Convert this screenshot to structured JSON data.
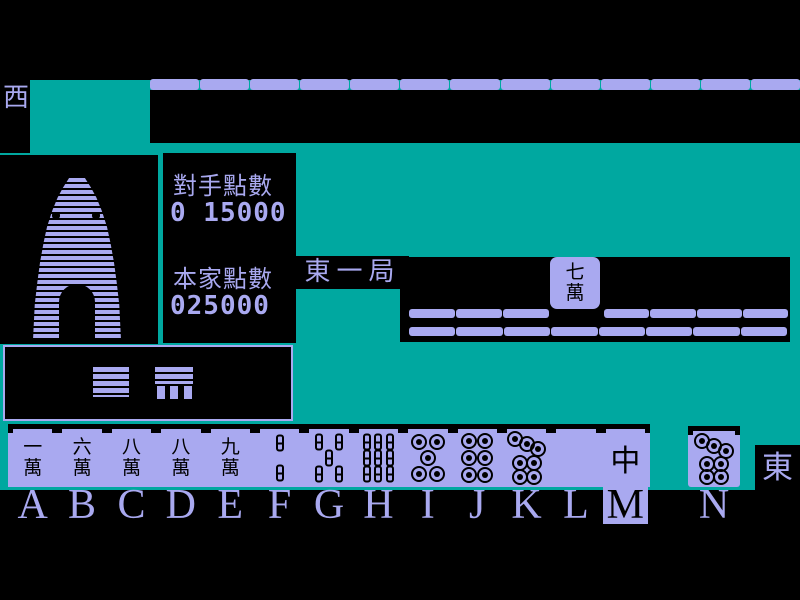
{
  "palette": {
    "teal": "#00A8A0",
    "lavender": "#A9A9F0",
    "black": "#000000"
  },
  "labels": {
    "west_wind": "西",
    "east_wind": "東",
    "round": "東一局"
  },
  "scoreboard": {
    "opponent_label": "對手點數",
    "opponent_value": "0 15000",
    "player_label": "本家點數",
    "player_value": "025000"
  },
  "discard": {
    "tile_text": "七萬"
  },
  "walls": {
    "top_segments": 13,
    "mid_upper_before_gap": 3,
    "mid_upper_after_gap": 4,
    "mid_lower_segments": 8
  },
  "hand": {
    "tiles": [
      {
        "key": "A",
        "kind": "man",
        "text": "一萬"
      },
      {
        "key": "B",
        "kind": "man",
        "text": "六萬"
      },
      {
        "key": "C",
        "kind": "man",
        "text": "八萬"
      },
      {
        "key": "D",
        "kind": "man",
        "text": "八萬"
      },
      {
        "key": "E",
        "kind": "man",
        "text": "九萬"
      },
      {
        "key": "F",
        "kind": "sou",
        "count": 2
      },
      {
        "key": "G",
        "kind": "sou",
        "count": 5
      },
      {
        "key": "H",
        "kind": "sou",
        "count": 9
      },
      {
        "key": "I",
        "kind": "pin",
        "count": 5
      },
      {
        "key": "J",
        "kind": "pin",
        "count": 6
      },
      {
        "key": "K",
        "kind": "pin",
        "count": 7
      },
      {
        "key": "L",
        "kind": "blank",
        "text": ""
      },
      {
        "key": "M",
        "kind": "dragon",
        "text": "中"
      }
    ],
    "drawn_tile": {
      "key": "N",
      "kind": "pin",
      "count": 7
    },
    "selected_key": "M"
  },
  "letters": [
    "A",
    "B",
    "C",
    "D",
    "E",
    "F",
    "G",
    "H",
    "I",
    "J",
    "K",
    "L",
    "M",
    "N"
  ],
  "tile_patterns": {
    "sou2": [
      [
        50,
        22
      ],
      [
        50,
        78
      ]
    ],
    "sou5": [
      [
        26,
        20
      ],
      [
        74,
        20
      ],
      [
        50,
        50
      ],
      [
        26,
        80
      ],
      [
        74,
        80
      ]
    ],
    "sou9": [
      [
        22,
        20
      ],
      [
        50,
        20
      ],
      [
        78,
        20
      ],
      [
        22,
        50
      ],
      [
        50,
        50
      ],
      [
        78,
        50
      ],
      [
        22,
        80
      ],
      [
        50,
        80
      ],
      [
        78,
        80
      ]
    ],
    "pin5": [
      [
        28,
        20
      ],
      [
        72,
        20
      ],
      [
        50,
        50
      ],
      [
        28,
        80
      ],
      [
        72,
        80
      ]
    ],
    "pin6": [
      [
        30,
        18
      ],
      [
        70,
        18
      ],
      [
        30,
        50
      ],
      [
        70,
        50
      ],
      [
        30,
        82
      ],
      [
        70,
        82
      ]
    ],
    "pin7": [
      [
        22,
        13
      ],
      [
        50,
        23
      ],
      [
        78,
        33
      ],
      [
        35,
        60
      ],
      [
        67,
        60
      ],
      [
        35,
        86
      ],
      [
        67,
        86
      ]
    ]
  }
}
